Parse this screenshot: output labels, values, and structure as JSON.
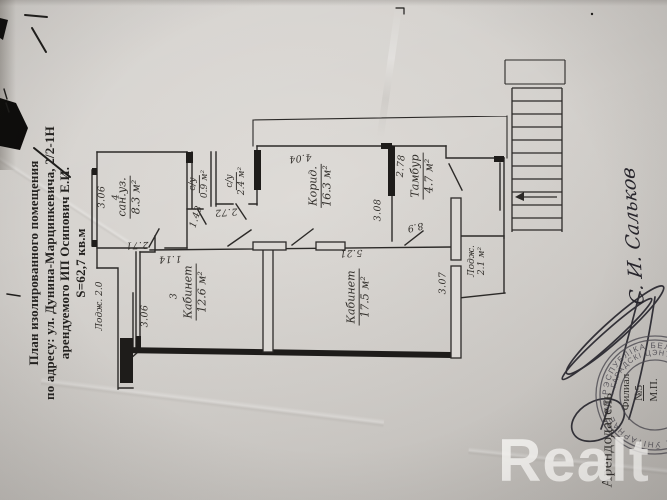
{
  "title_block": {
    "line1": "План изолированного помещения",
    "line2": "по адресу: ул. Дунина-Марцинкевича, 2/2-1Н",
    "line3": "арендуемого ИП Осипович Е.И.",
    "line4": "S=62,7 кв.м"
  },
  "plan": {
    "labels": [
      {
        "text": "3.06",
        "x": 103,
        "y": 197,
        "rot": -90,
        "dim": true
      },
      {
        "text": "4",
        "x": 117,
        "y": 197,
        "rot": -90,
        "dim": true
      },
      {
        "text": "сан.уз.",
        "sub": "8.3 м²",
        "x": 130,
        "y": 197,
        "rot": -90,
        "underline": true
      },
      {
        "text": "2.71",
        "x": 137,
        "y": 244,
        "rot": 178,
        "dim": true
      },
      {
        "text": "1.43",
        "x": 197,
        "y": 217,
        "rot": -72,
        "dim": true
      },
      {
        "text": "с/у",
        "sub": "0.9 м²",
        "x": 199,
        "y": 184,
        "rot": -90,
        "underline": true,
        "small": true
      },
      {
        "text": "с/у",
        "sub": "2.4 м²",
        "x": 236,
        "y": 181,
        "rot": -90,
        "underline": true,
        "small": true
      },
      {
        "text": "2.72",
        "x": 226,
        "y": 211,
        "rot": 176,
        "dim": true
      },
      {
        "text": "4.04",
        "x": 300,
        "y": 157,
        "rot": 173,
        "dim": true
      },
      {
        "text": "Корид.",
        "sub": "16.3 м²",
        "x": 321,
        "y": 186,
        "rot": -90,
        "underline": true
      },
      {
        "text": "3.08",
        "x": 379,
        "y": 210,
        "rot": -90,
        "dim": true
      },
      {
        "text": "2.78",
        "x": 402,
        "y": 166,
        "rot": -85,
        "dim": true
      },
      {
        "text": "Тамбур",
        "sub": "4.7 м²",
        "x": 423,
        "y": 176,
        "rot": -90,
        "underline": true
      },
      {
        "text": "8.9",
        "x": 415,
        "y": 226,
        "rot": 168,
        "dim": true
      },
      {
        "text": "5.21",
        "x": 351,
        "y": 252,
        "rot": 178,
        "dim": true
      },
      {
        "text": "Кабинет",
        "sub": "17.5 м²",
        "x": 359,
        "y": 297,
        "rot": -90,
        "underline": true
      },
      {
        "text": "3",
        "x": 175,
        "y": 296,
        "rot": -90,
        "dim": true
      },
      {
        "text": "Кабинет",
        "sub": "12.6 м²",
        "x": 196,
        "y": 292,
        "rot": -90,
        "underline": true
      },
      {
        "text": "1.14",
        "x": 170,
        "y": 258,
        "rot": 178,
        "dim": true
      },
      {
        "text": "3.06",
        "x": 146,
        "y": 316,
        "rot": -90,
        "dim": true
      },
      {
        "text": "Лодж. 2.0",
        "x": 100,
        "y": 306,
        "rot": -90,
        "small": true
      },
      {
        "text": "3.07",
        "x": 444,
        "y": 283,
        "rot": -90,
        "dim": true
      },
      {
        "text": "Лодж.",
        "sub": "2.1 м²",
        "x": 477,
        "y": 261,
        "rot": -90,
        "small": true
      }
    ]
  },
  "legal": {
    "lessor_label": "Арендодатель",
    "signature_name": "С. И. Сальков",
    "filial": "Филиал",
    "filial_no": "№5",
    "seal_mark": "М.П."
  },
  "stamp": {
    "ring_outer": "РЭСПУБЛІКА БЕЛАРУСЬ • КАМУНАЛЬНАЕ ЎНІТАРНАЕ ПРАДПРЫЕМСТВА •",
    "ring_inner": "• ГАРАДСКІ ЦЭНТР НЕРУХОМАСЦІ •"
  },
  "watermark": {
    "text": "Realt"
  },
  "colors": {
    "paper": "#d6d3cf",
    "ink": "#2c2a28",
    "stamp_ink": "#45434b",
    "watermark": "rgba(251,250,248,0.82)"
  }
}
